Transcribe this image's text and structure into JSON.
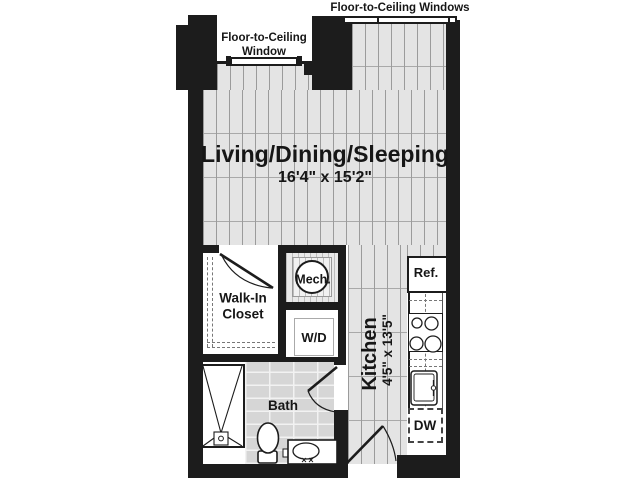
{
  "plan": {
    "windows_top_label": "Floor-to-Ceiling Windows",
    "window_left_label": {
      "line1": "Floor-to-Ceiling",
      "line2": "Window"
    },
    "rooms": {
      "living": {
        "name": "Living/Dining/Sleeping",
        "dimensions": "16'4\" x 15'2\""
      },
      "kitchen": {
        "name": "Kitchen",
        "dimensions": "4'5\" x 13'5\""
      },
      "bath": {
        "name": "Bath"
      },
      "walk_in_closet": {
        "line1": "Walk-In",
        "line2": "Closet"
      },
      "mech": {
        "name": "Mech."
      },
      "laundry": {
        "name": "W/D"
      }
    },
    "appliances": {
      "refrigerator": "Ref.",
      "dishwasher": "DW"
    }
  },
  "colors": {
    "wall": "#1c1c1c",
    "floor": "#e4e4e4",
    "floor_line": "#9b9b9b",
    "bath_tile": "#d6d6d6",
    "background": "#ffffff"
  }
}
